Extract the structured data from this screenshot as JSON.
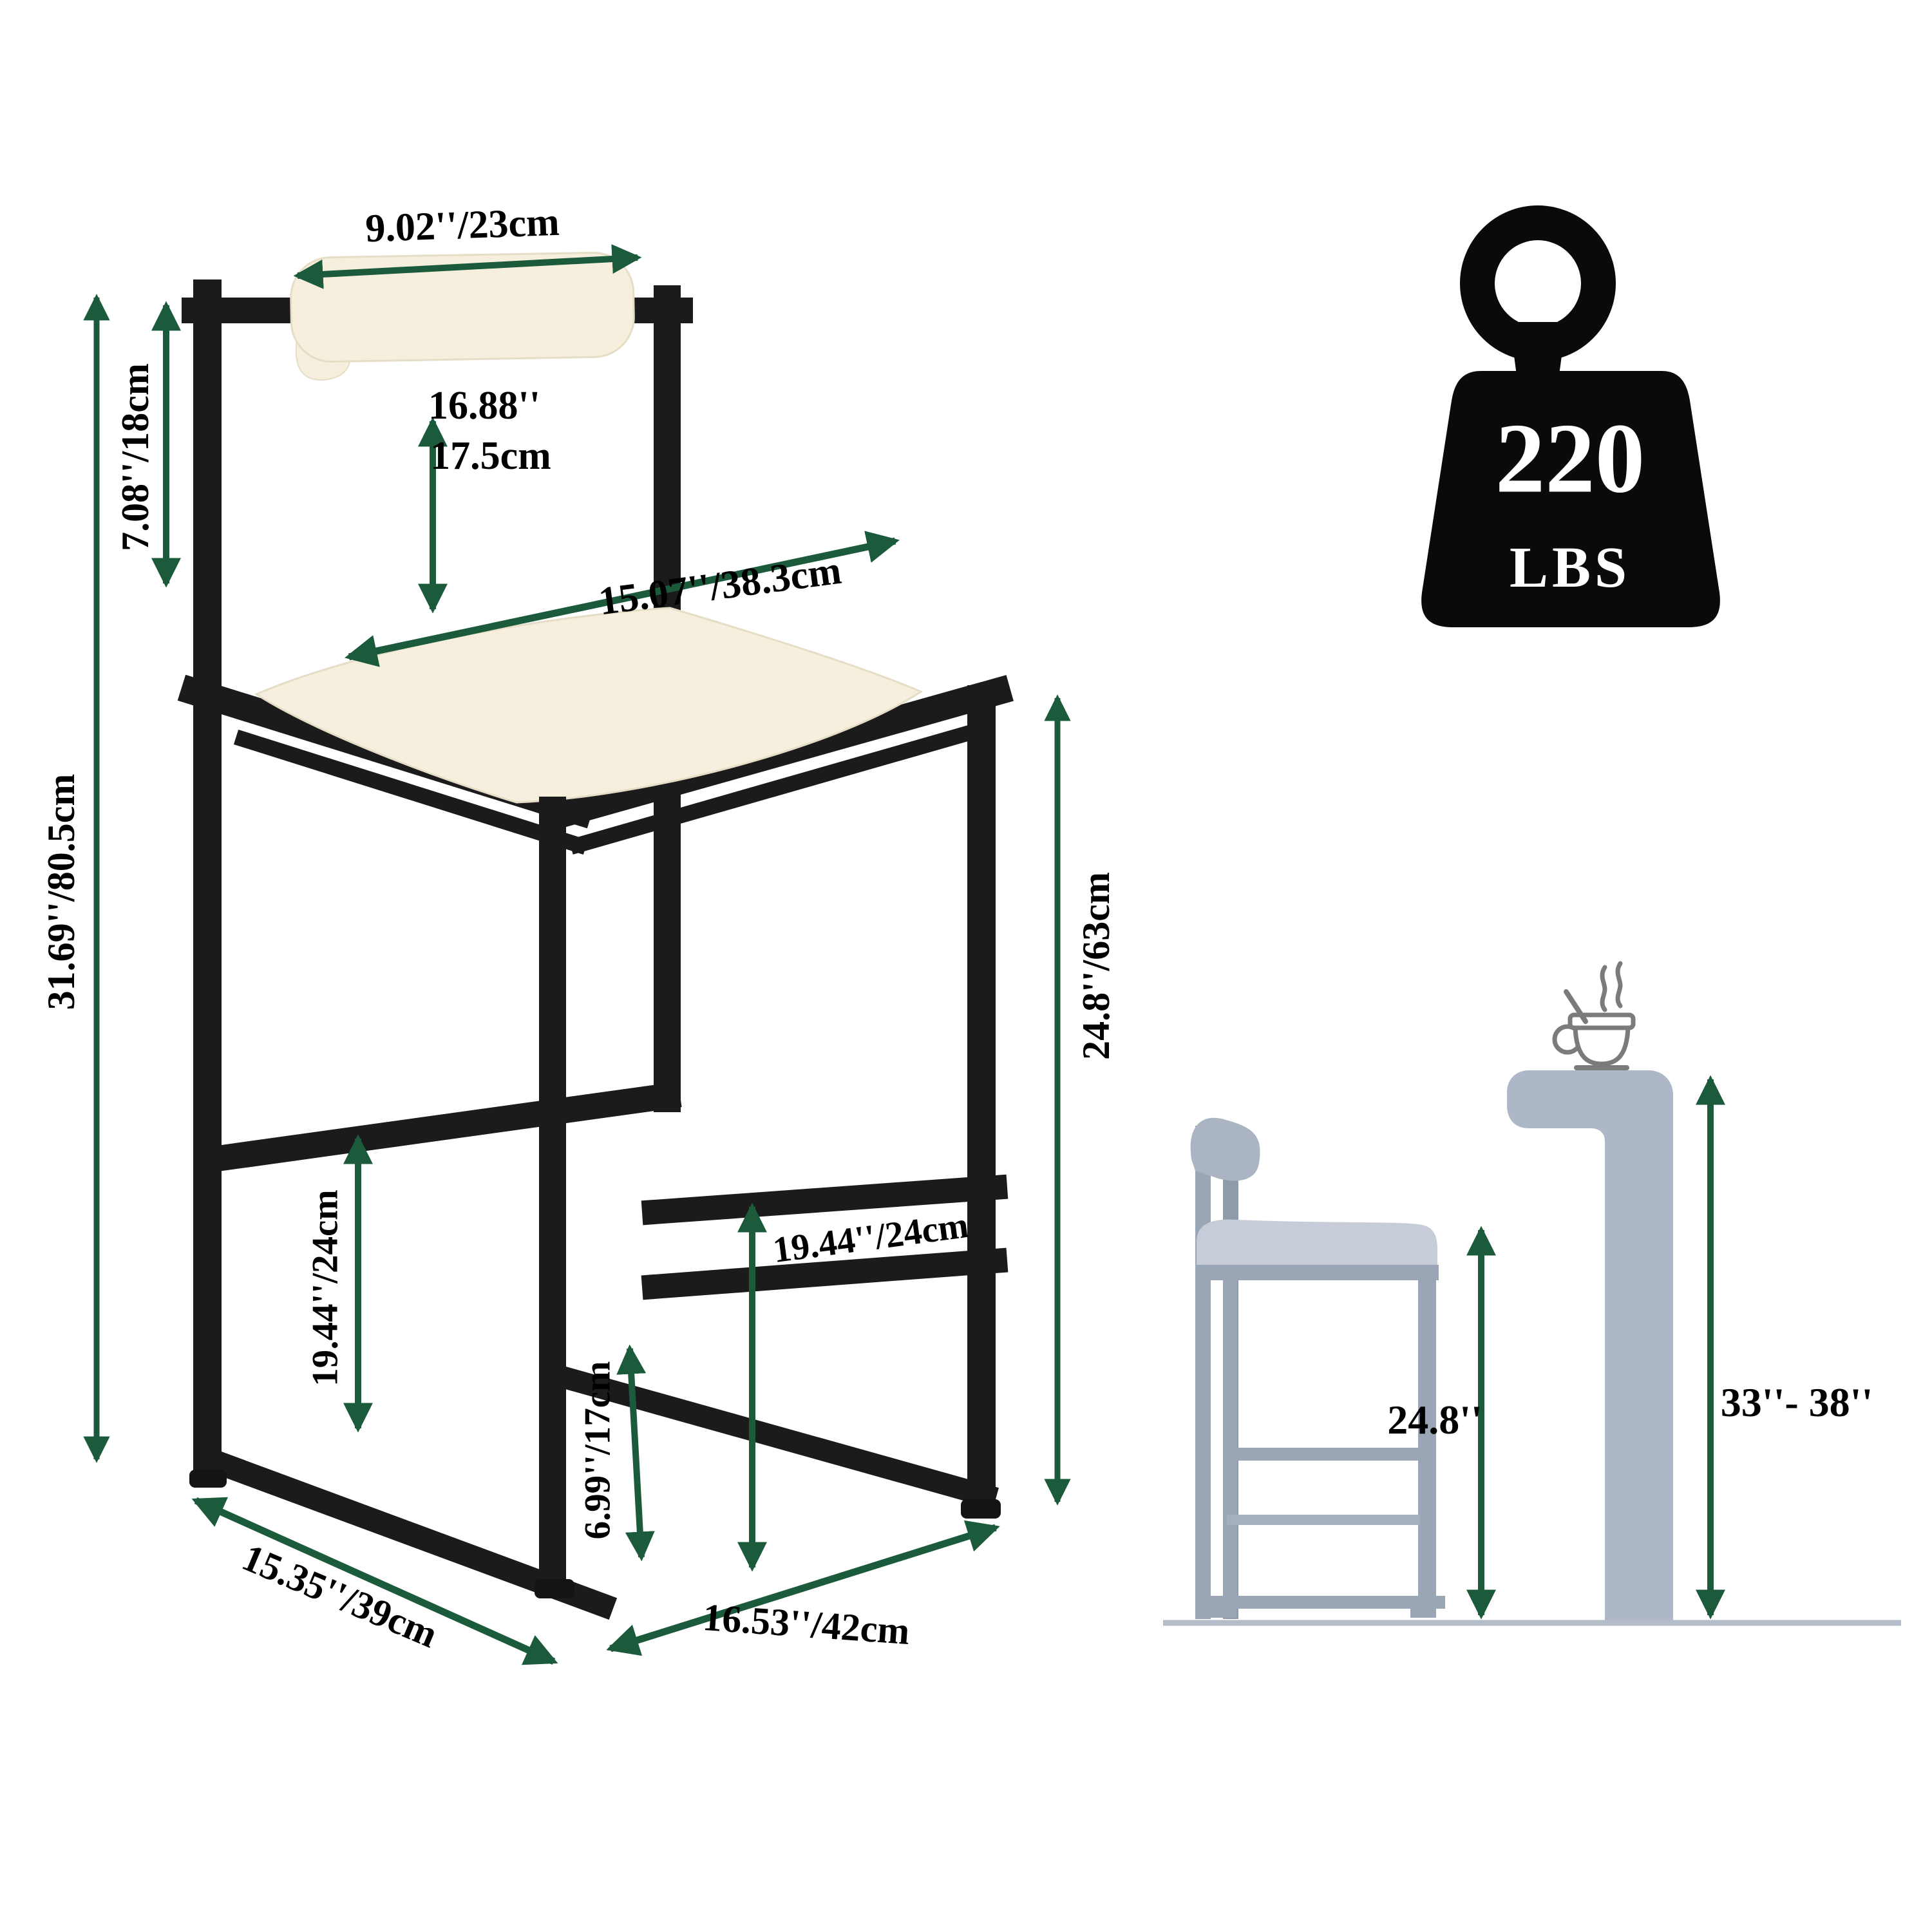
{
  "page": {
    "background": "#ffffff"
  },
  "colors": {
    "dimension_green": "#1c5a3c",
    "frame_black": "#1b1b1b",
    "cushion_cream": "#f6efde",
    "weight_icon_black": "#0a0a0a",
    "weight_text_white": "#ffffff",
    "silhouette_gray": "#9aa5b6",
    "silhouette_cushion_gray": "#c6cdd9",
    "bar_gray": "#aeb7c7",
    "cup_outline_gray": "#7b7b7b",
    "floor_gray": "#b5bcc9"
  },
  "stool_diagram": {
    "dimensions": {
      "backrest_width": "9.02''/23cm",
      "backrest_height": "7.08''/18cm",
      "seat_to_backrest_inches": "16.88''",
      "seat_to_backrest_cm": "17.5cm",
      "seat_depth": "15.07''/38.3cm",
      "total_height": "31.69''/80.5cm",
      "floor_to_seat_height": "24.8''/63cm",
      "footrest_clearance_left": "19.44''/24cm",
      "footrest_clearance_right": "19.44''/24cm",
      "lower_footrest_height": "6.99''/17cm",
      "base_depth": "15.35''/39cm",
      "base_width": "16.53''/42cm"
    }
  },
  "weight_capacity": {
    "value": "220",
    "unit": "LBS"
  },
  "height_comparison": {
    "stool_seat_height": "24.8''",
    "counter_height_range": "33''- 38''"
  }
}
